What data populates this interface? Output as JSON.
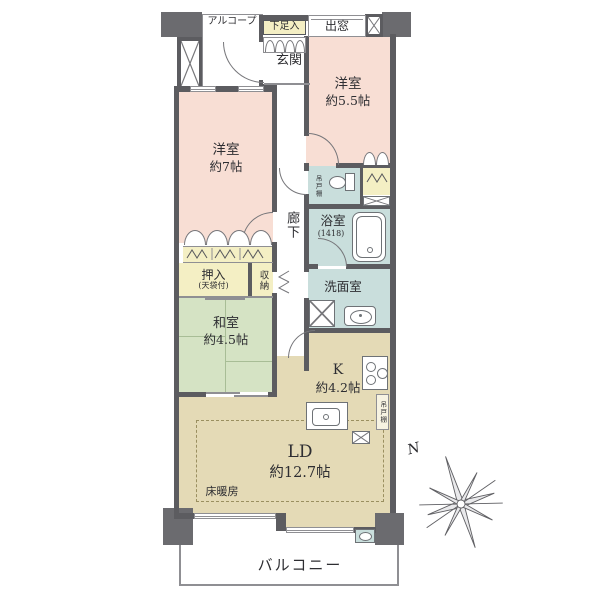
{
  "plan_type": "apartment-floorplan",
  "rooms": {
    "alcove": {
      "name": "アルコープ"
    },
    "entrance": {
      "name": "玄関"
    },
    "bedroom55": {
      "name": "洋室",
      "size": "約5.5帖"
    },
    "bedroom7": {
      "name": "洋室",
      "size": "約7帖"
    },
    "corridor": {
      "name": "廊下"
    },
    "bath": {
      "name": "浴室",
      "size": "(1418)"
    },
    "washroom": {
      "name": "洗面室"
    },
    "washitsu": {
      "name": "和室",
      "size": "約4.5帖"
    },
    "kitchen": {
      "name": "K",
      "size": "約4.2帖"
    },
    "living": {
      "name": "LD",
      "size": "約12.7帖"
    },
    "balcony": {
      "name": "バルコニー"
    }
  },
  "features": {
    "shoe_cabinet": "下足入",
    "bay_window": "出窓",
    "oshiire": "押入",
    "oshiire_note": "(天袋付)",
    "storage": "収納",
    "hanging_shelf_toilet": "吊戸棚",
    "hanging_shelf_kitchen": "吊戸棚",
    "floor_heating": "床暖房",
    "compass_north": "N"
  },
  "colors": {
    "wall": "#5c5c60",
    "western_room": "#f8ded4",
    "tatami_room": "#d5e3c4",
    "living_kitchen": "#e4dab6",
    "wet_area": "#c9dedc",
    "closet": "#f4efc4",
    "outline": "#8f8f93"
  }
}
